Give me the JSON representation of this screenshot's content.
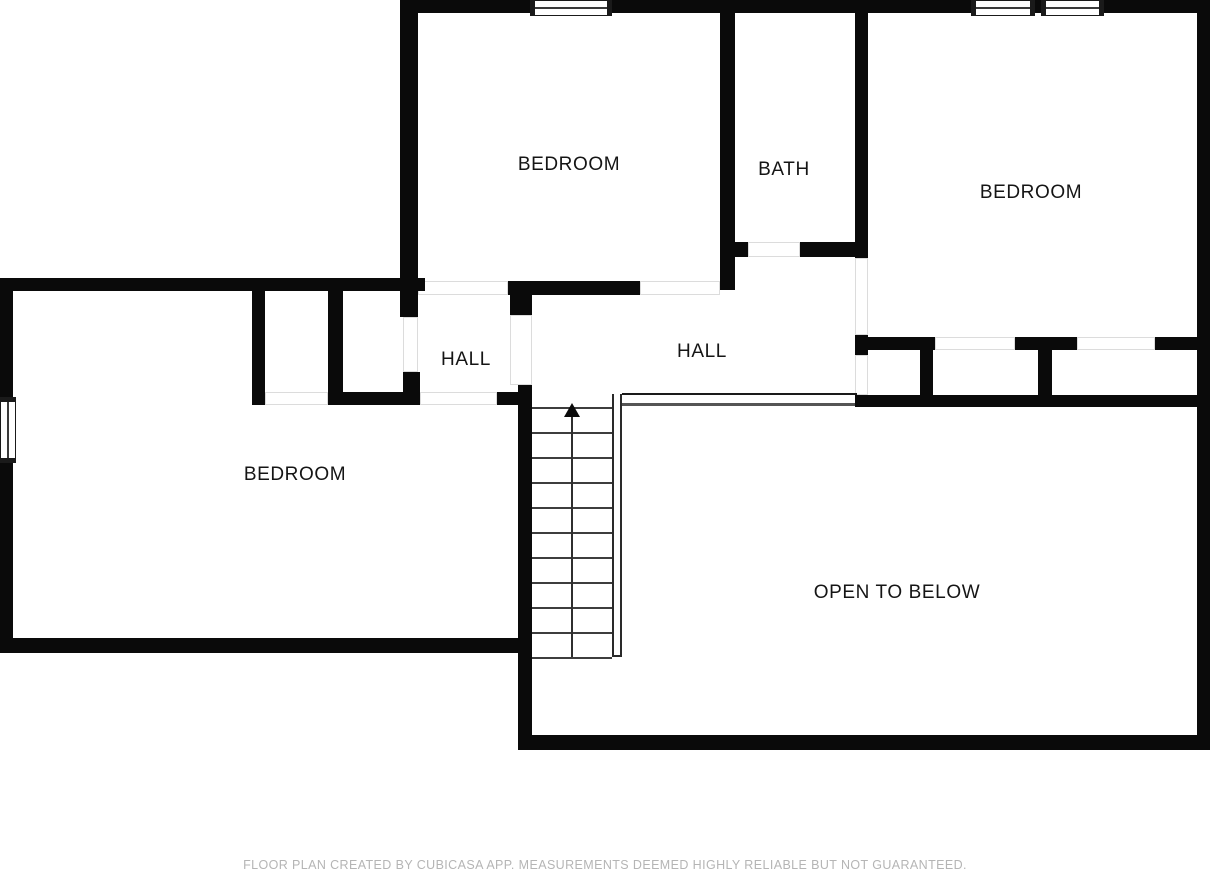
{
  "plan": {
    "background": "#ffffff",
    "wall_color": "#0a0a0a",
    "thin_line_color": "#555555",
    "label_color": "#151515",
    "footer_color": "#b5b5b5",
    "labels": [
      {
        "id": "bedroom-top",
        "text": "BEDROOM",
        "cx": 569,
        "cy": 165
      },
      {
        "id": "bath",
        "text": "BATH",
        "cx": 784,
        "cy": 170
      },
      {
        "id": "bedroom-right",
        "text": "BEDROOM",
        "cx": 1031,
        "cy": 193
      },
      {
        "id": "hall-left",
        "text": "HALL",
        "cx": 466,
        "cy": 360
      },
      {
        "id": "hall-center",
        "text": "HALL",
        "cx": 702,
        "cy": 352
      },
      {
        "id": "bedroom-left",
        "text": "BEDROOM",
        "cx": 295,
        "cy": 475
      },
      {
        "id": "open-to-below",
        "text": "OPEN TO BELOW",
        "cx": 897,
        "cy": 593
      }
    ],
    "walls": [
      {
        "name": "top-outer-wall",
        "x": 400,
        "y": 0,
        "w": 810,
        "h": 13
      },
      {
        "name": "top-bedroom-left-wall",
        "x": 400,
        "y": 0,
        "w": 18,
        "h": 317
      },
      {
        "name": "bath-left-wall",
        "x": 720,
        "y": 13,
        "w": 15,
        "h": 277
      },
      {
        "name": "bath-bottom-stub",
        "x": 720,
        "y": 242,
        "w": 28,
        "h": 15
      },
      {
        "name": "bath-bottom-wall",
        "x": 800,
        "y": 242,
        "w": 68,
        "h": 15
      },
      {
        "name": "hall-bedroom-divider-wall",
        "x": 855,
        "y": 13,
        "w": 13,
        "h": 245
      },
      {
        "name": "divider-bottom-stub",
        "x": 855,
        "y": 335,
        "w": 13,
        "h": 20
      },
      {
        "name": "right-outer-wall",
        "x": 1197,
        "y": 0,
        "w": 13,
        "h": 750
      },
      {
        "name": "left-area-top-wall",
        "x": 0,
        "y": 278,
        "w": 425,
        "h": 13
      },
      {
        "name": "left-outer-wall",
        "x": 0,
        "y": 278,
        "w": 13,
        "h": 375
      },
      {
        "name": "closet-a-left-wall",
        "x": 252,
        "y": 291,
        "w": 13,
        "h": 114
      },
      {
        "name": "closet-b-left-wall",
        "x": 328,
        "y": 291,
        "w": 15,
        "h": 114
      },
      {
        "name": "closet-bottom-wall",
        "x": 328,
        "y": 392,
        "w": 92,
        "h": 13
      },
      {
        "name": "hall-left-bottom-stub",
        "x": 403,
        "y": 372,
        "w": 17,
        "h": 33
      },
      {
        "name": "hall-right-top-stub",
        "x": 510,
        "y": 291,
        "w": 22,
        "h": 24
      },
      {
        "name": "top-bedroom-bottom-wall",
        "x": 508,
        "y": 281,
        "w": 132,
        "h": 14
      },
      {
        "name": "stair-left-wall",
        "x": 518,
        "y": 385,
        "w": 14,
        "h": 365
      },
      {
        "name": "hall-right-bottom-stub",
        "x": 497,
        "y": 392,
        "w": 35,
        "h": 13
      },
      {
        "name": "left-bedroom-bottom-wall",
        "x": 0,
        "y": 638,
        "w": 532,
        "h": 15
      },
      {
        "name": "open-below-bottom-wall",
        "x": 518,
        "y": 735,
        "w": 692,
        "h": 15
      },
      {
        "name": "right-bedroom-bottom-wall-1",
        "x": 868,
        "y": 337,
        "w": 67,
        "h": 13
      },
      {
        "name": "right-bedroom-bottom-wall-2",
        "x": 1015,
        "y": 337,
        "w": 62,
        "h": 13
      },
      {
        "name": "right-bedroom-bottom-wall-3",
        "x": 1155,
        "y": 337,
        "w": 55,
        "h": 13
      },
      {
        "name": "closet-strip-stub-1",
        "x": 920,
        "y": 337,
        "w": 13,
        "h": 60
      },
      {
        "name": "closet-strip-stub-2",
        "x": 1038,
        "y": 337,
        "w": 14,
        "h": 60
      },
      {
        "name": "closet-strip-bottom-wall",
        "x": 855,
        "y": 395,
        "w": 342,
        "h": 12
      }
    ],
    "door_openings": [
      {
        "name": "top-bedroom-door-left",
        "x": 418,
        "y": 281,
        "w": 90,
        "h": 14
      },
      {
        "name": "top-bedroom-door-right",
        "x": 640,
        "y": 281,
        "w": 80,
        "h": 14
      },
      {
        "name": "bath-door",
        "x": 748,
        "y": 242,
        "w": 52,
        "h": 15
      },
      {
        "name": "right-bedroom-entry-door",
        "x": 855,
        "y": 258,
        "w": 13,
        "h": 77
      },
      {
        "name": "right-closet-door-1",
        "x": 935,
        "y": 337,
        "w": 80,
        "h": 13
      },
      {
        "name": "right-closet-door-2",
        "x": 1077,
        "y": 337,
        "w": 78,
        "h": 13
      },
      {
        "name": "closet-a-door",
        "x": 265,
        "y": 392,
        "w": 63,
        "h": 13
      },
      {
        "name": "hall-left-door",
        "x": 403,
        "y": 317,
        "w": 15,
        "h": 55
      },
      {
        "name": "hall-right-door",
        "x": 510,
        "y": 315,
        "w": 22,
        "h": 70
      },
      {
        "name": "left-bedroom-door",
        "x": 420,
        "y": 392,
        "w": 77,
        "h": 13
      },
      {
        "name": "strip-left-opening",
        "x": 855,
        "y": 355,
        "w": 13,
        "h": 40
      }
    ],
    "thin_lines": [
      {
        "name": "railing-top-line",
        "x": 622,
        "y": 393,
        "w": 235,
        "h": 2,
        "color": "#1a1a1a"
      },
      {
        "name": "railing-bottom-line",
        "x": 620,
        "y": 403,
        "w": 237,
        "h": 3,
        "color": "#555555"
      }
    ],
    "rails": [
      {
        "name": "stair-right-rail",
        "x": 612,
        "y": 394,
        "w": 10,
        "h": 263
      }
    ],
    "windows": [
      {
        "name": "top-bedroom-window",
        "x": 530,
        "y": 0,
        "w": 82,
        "h": 16,
        "orient": "h"
      },
      {
        "name": "right-bedroom-window-1",
        "x": 971,
        "y": 0,
        "w": 64,
        "h": 16,
        "orient": "h"
      },
      {
        "name": "right-bedroom-window-2",
        "x": 1041,
        "y": 0,
        "w": 63,
        "h": 16,
        "orient": "h"
      },
      {
        "name": "left-bedroom-window",
        "x": 0,
        "y": 397,
        "w": 16,
        "h": 66,
        "orient": "v"
      }
    ],
    "stairs": {
      "x": 532,
      "y": 395,
      "w": 80,
      "h": 262,
      "tread_start": 12,
      "tread_step": 25,
      "tread_count": 11,
      "direction": "up"
    },
    "footer": {
      "text": "FLOOR PLAN CREATED BY CUBICASA APP. MEASUREMENTS DEEMED HIGHLY RELIABLE BUT NOT GUARANTEED."
    }
  }
}
